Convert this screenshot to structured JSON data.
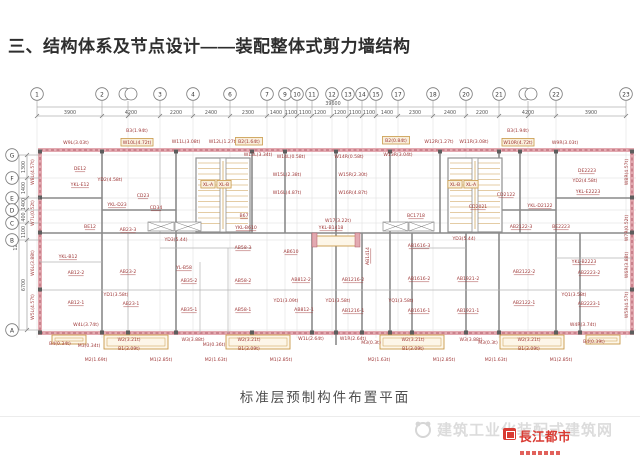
{
  "title": "三、结构体系及节点设计——装配整体式剪力墙结构",
  "caption": "标准层预制构件布置平面",
  "watermark": {
    "site_text": "建筑工业化装配式建筑网",
    "logo_text": "長江都市"
  },
  "colors": {
    "label_red": "#9e3636",
    "wall_pink": "#e3aab1",
    "wall_accent": "#b05866",
    "box_tan": "#c99a4a",
    "logo_red": "#d93a32",
    "dim_gray": "#555555"
  },
  "plan": {
    "grid_top": {
      "total": "39600",
      "bubbles": [
        {
          "n": "1",
          "x": 37
        },
        {
          "n": "2",
          "x": 102
        },
        {
          "n": "",
          "x": 128,
          "d": 1
        },
        {
          "n": "3",
          "x": 160
        },
        {
          "n": "4",
          "x": 193
        },
        {
          "n": "6",
          "x": 230
        },
        {
          "n": "7",
          "x": 267
        },
        {
          "n": "9",
          "x": 285
        },
        {
          "n": "10",
          "x": 297
        },
        {
          "n": "11",
          "x": 312
        },
        {
          "n": "12",
          "x": 332
        },
        {
          "n": "13",
          "x": 348
        },
        {
          "n": "14",
          "x": 362
        },
        {
          "n": "15",
          "x": 376
        },
        {
          "n": "17",
          "x": 398
        },
        {
          "n": "18",
          "x": 433
        },
        {
          "n": "20",
          "x": 466
        },
        {
          "n": "21",
          "x": 499
        },
        {
          "n": "",
          "x": 528,
          "d": 1
        },
        {
          "n": "22",
          "x": 556
        },
        {
          "n": "23",
          "x": 626
        }
      ],
      "dims": [
        {
          "v": "3900",
          "x": 70
        },
        {
          "v": "4200",
          "x": 131
        },
        {
          "v": "2200",
          "x": 176
        },
        {
          "v": "2400",
          "x": 211
        },
        {
          "v": "2300",
          "x": 248
        },
        {
          "v": "1400",
          "x": 276
        },
        {
          "v": "1100",
          "x": 291
        },
        {
          "v": "1100",
          "x": 305
        },
        {
          "v": "1200",
          "x": 320
        },
        {
          "v": "1200",
          "x": 340
        },
        {
          "v": "1100",
          "x": 355
        },
        {
          "v": "1100",
          "x": 369
        },
        {
          "v": "1400",
          "x": 387
        },
        {
          "v": "2300",
          "x": 415
        },
        {
          "v": "2400",
          "x": 450
        },
        {
          "v": "2200",
          "x": 482
        },
        {
          "v": "4200",
          "x": 528
        },
        {
          "v": "3900",
          "x": 591
        }
      ]
    },
    "grid_left": {
      "total": "12300",
      "bubbles": [
        {
          "n": "G",
          "y": 155
        },
        {
          "n": "F",
          "y": 178
        },
        {
          "n": "E",
          "y": 198
        },
        {
          "n": "D",
          "y": 210
        },
        {
          "n": "C",
          "y": 223
        },
        {
          "n": "B",
          "y": 240
        },
        {
          "n": "A",
          "y": 330
        }
      ],
      "dims": [
        {
          "v": "1300",
          "y": 167
        },
        {
          "v": "1400",
          "y": 188
        },
        {
          "v": "1400",
          "y": 204
        },
        {
          "v": "400",
          "y": 217
        },
        {
          "v": "1100",
          "y": 232
        },
        {
          "v": "6700",
          "y": 285
        }
      ]
    },
    "labels": [
      {
        "t": "W9L(3.03t)",
        "x": 76,
        "y": 144
      },
      {
        "t": "B3(1.94t)",
        "x": 137,
        "y": 132
      },
      {
        "t": "W10L(4.72t)",
        "x": 137,
        "y": 144,
        "b": 1
      },
      {
        "t": "W11L(3.08t)",
        "x": 186,
        "y": 143
      },
      {
        "t": "W12L(1.27t)",
        "x": 223,
        "y": 143
      },
      {
        "t": "B2(1.64t)",
        "x": 249,
        "y": 143,
        "b": 1
      },
      {
        "t": "W13L(3.34t)",
        "x": 258,
        "y": 156
      },
      {
        "t": "W14L(0.58t)",
        "x": 291,
        "y": 158
      },
      {
        "t": "W15L(2.38t)",
        "x": 287,
        "y": 176
      },
      {
        "t": "W16L(4.87t)",
        "x": 287,
        "y": 194
      },
      {
        "t": "W14R(0.58t)",
        "x": 349,
        "y": 158
      },
      {
        "t": "W15R(2.30t)",
        "x": 353,
        "y": 176
      },
      {
        "t": "W16R(4.87t)",
        "x": 353,
        "y": 194
      },
      {
        "t": "B2(0.84t)",
        "x": 396,
        "y": 142,
        "b": 1
      },
      {
        "t": "W13R(3.04t)",
        "x": 398,
        "y": 156
      },
      {
        "t": "W12R(1.27t)",
        "x": 439,
        "y": 143
      },
      {
        "t": "W11R(3.08t)",
        "x": 474,
        "y": 143
      },
      {
        "t": "B3(1.94t)",
        "x": 518,
        "y": 132
      },
      {
        "t": "W10R(4.72t)",
        "x": 518,
        "y": 144,
        "b": 1
      },
      {
        "t": "W9R(3.03t)",
        "x": 565,
        "y": 144
      },
      {
        "t": "DE12",
        "x": 80,
        "y": 170,
        "u": 1
      },
      {
        "t": "YD2(4.58t)",
        "x": 110,
        "y": 181
      },
      {
        "t": "YKL-E12",
        "x": 80,
        "y": 186,
        "u": 1
      },
      {
        "t": "CD23",
        "x": 143,
        "y": 197,
        "u": 1
      },
      {
        "t": "YKL-D23",
        "x": 117,
        "y": 206,
        "u": 1
      },
      {
        "t": "CD34",
        "x": 156,
        "y": 209,
        "u": 1
      },
      {
        "t": "XL-A",
        "x": 208,
        "y": 186,
        "b": 1
      },
      {
        "t": "XL-B",
        "x": 224,
        "y": 186,
        "b": 1
      },
      {
        "t": "XL-B",
        "x": 455,
        "y": 186,
        "b": 1
      },
      {
        "t": "XL-A",
        "x": 471,
        "y": 186,
        "b": 1
      },
      {
        "t": "CD2122",
        "x": 506,
        "y": 196,
        "u": 1
      },
      {
        "t": "CD2021",
        "x": 478,
        "y": 208,
        "u": 1
      },
      {
        "t": "YKL-D2122",
        "x": 540,
        "y": 207,
        "u": 1
      },
      {
        "t": "DE2223",
        "x": 587,
        "y": 172,
        "u": 1
      },
      {
        "t": "YD2(4.58t)",
        "x": 585,
        "y": 182
      },
      {
        "t": "YKL-E2223",
        "x": 588,
        "y": 193,
        "u": 1
      },
      {
        "t": "BE12",
        "x": 90,
        "y": 228,
        "u": 1
      },
      {
        "t": "AB23-3",
        "x": 128,
        "y": 231,
        "u": 1
      },
      {
        "t": "B67",
        "x": 244,
        "y": 217,
        "u": 1
      },
      {
        "t": "YD3(5.44)",
        "x": 176,
        "y": 241
      },
      {
        "t": "W17(3.22t)",
        "x": 338,
        "y": 222
      },
      {
        "t": "YKL-B610",
        "x": 246,
        "y": 229,
        "u": 1
      },
      {
        "t": "YKL-B1418",
        "x": 331,
        "y": 229,
        "u": 1
      },
      {
        "t": "BC1718",
        "x": 416,
        "y": 217,
        "u": 1
      },
      {
        "t": "AB2122-3",
        "x": 521,
        "y": 228,
        "u": 1
      },
      {
        "t": "BE2223",
        "x": 561,
        "y": 228,
        "u": 1
      },
      {
        "t": "YD3(5.44)",
        "x": 464,
        "y": 240
      },
      {
        "t": "AB1616-3",
        "x": 419,
        "y": 247,
        "u": 1
      },
      {
        "t": "AB58-3",
        "x": 243,
        "y": 249,
        "u": 1
      },
      {
        "t": "AB610",
        "x": 291,
        "y": 253,
        "u": 1
      },
      {
        "t": "AB1414",
        "x": 369,
        "y": 256,
        "r": -90,
        "u": 1
      },
      {
        "t": "YKL-B12",
        "x": 68,
        "y": 258,
        "u": 1
      },
      {
        "t": "AB12-2",
        "x": 76,
        "y": 274,
        "u": 1
      },
      {
        "t": "AB23-2",
        "x": 128,
        "y": 273,
        "u": 1
      },
      {
        "t": "YL-B58",
        "x": 184,
        "y": 269,
        "u": 1
      },
      {
        "t": "AB35-2",
        "x": 189,
        "y": 282,
        "u": 1
      },
      {
        "t": "AB58-2",
        "x": 243,
        "y": 282,
        "u": 1
      },
      {
        "t": "AB812-2",
        "x": 301,
        "y": 281,
        "u": 1
      },
      {
        "t": "AB1216-2",
        "x": 353,
        "y": 281,
        "u": 1
      },
      {
        "t": "AB1616-2",
        "x": 419,
        "y": 280,
        "u": 1
      },
      {
        "t": "AB1921-2",
        "x": 468,
        "y": 280,
        "u": 1
      },
      {
        "t": "AB2122-2",
        "x": 524,
        "y": 273,
        "u": 1
      },
      {
        "t": "YKL-B2223",
        "x": 584,
        "y": 263,
        "u": 1
      },
      {
        "t": "AB2223-2",
        "x": 589,
        "y": 274,
        "u": 1
      },
      {
        "t": "AB12-1",
        "x": 76,
        "y": 304,
        "u": 1
      },
      {
        "t": "YD1(3.58t)",
        "x": 116,
        "y": 296
      },
      {
        "t": "AB23-1",
        "x": 131,
        "y": 305,
        "u": 1
      },
      {
        "t": "AB35-1",
        "x": 189,
        "y": 311,
        "u": 1
      },
      {
        "t": "AB58-1",
        "x": 243,
        "y": 311,
        "u": 1
      },
      {
        "t": "YD1(3.09t)",
        "x": 286,
        "y": 302
      },
      {
        "t": "AB812-1",
        "x": 304,
        "y": 311,
        "u": 1
      },
      {
        "t": "YD1(3.58t)",
        "x": 338,
        "y": 302
      },
      {
        "t": "AB1216-1",
        "x": 353,
        "y": 312,
        "u": 1
      },
      {
        "t": "YQ1(3.58t)",
        "x": 401,
        "y": 302
      },
      {
        "t": "AB1616-1",
        "x": 419,
        "y": 312,
        "u": 1
      },
      {
        "t": "AB1921-1",
        "x": 468,
        "y": 312,
        "u": 1
      },
      {
        "t": "AB2122-1",
        "x": 524,
        "y": 304,
        "u": 1
      },
      {
        "t": "YQ1(3.58t)",
        "x": 574,
        "y": 296
      },
      {
        "t": "AB2223-1",
        "x": 589,
        "y": 305,
        "u": 1
      },
      {
        "t": "W4L(3.74t)",
        "x": 86,
        "y": 326
      },
      {
        "t": "B4(0.34t)",
        "x": 60,
        "y": 345
      },
      {
        "t": "M3(0.34t)",
        "x": 89,
        "y": 347
      },
      {
        "t": "W2(3.21t)",
        "x": 129,
        "y": 341
      },
      {
        "t": "B1(3.09t)",
        "x": 129,
        "y": 350
      },
      {
        "t": "M2(1.69t)",
        "x": 96,
        "y": 361
      },
      {
        "t": "M1(2.85t)",
        "x": 161,
        "y": 361
      },
      {
        "t": "W3(3.88t)",
        "x": 193,
        "y": 341
      },
      {
        "t": "M3(0.36t)",
        "x": 214,
        "y": 346
      },
      {
        "t": "W2(3.21t)",
        "x": 249,
        "y": 341
      },
      {
        "t": "B1(3.09t)",
        "x": 249,
        "y": 350
      },
      {
        "t": "M2(1.63t)",
        "x": 216,
        "y": 361
      },
      {
        "t": "M1(2.85t)",
        "x": 281,
        "y": 361
      },
      {
        "t": "W1L(2.64t)",
        "x": 311,
        "y": 340
      },
      {
        "t": "W1R(2.64t)",
        "x": 353,
        "y": 340
      },
      {
        "t": "M3(0.3t)",
        "x": 371,
        "y": 344
      },
      {
        "t": "W2(3.21t)",
        "x": 413,
        "y": 341
      },
      {
        "t": "B1(3.09t)",
        "x": 413,
        "y": 350
      },
      {
        "t": "M2(1.63t)",
        "x": 379,
        "y": 361
      },
      {
        "t": "M1(2.85t)",
        "x": 444,
        "y": 361
      },
      {
        "t": "W3(3.88t)",
        "x": 471,
        "y": 341
      },
      {
        "t": "M3(0.3t)",
        "x": 488,
        "y": 344
      },
      {
        "t": "W2(3.21t)",
        "x": 529,
        "y": 341
      },
      {
        "t": "B1(3.09t)",
        "x": 529,
        "y": 350
      },
      {
        "t": "M2(1.63t)",
        "x": 496,
        "y": 361
      },
      {
        "t": "M1(2.85t)",
        "x": 561,
        "y": 361
      },
      {
        "t": "W4R(3.74t)",
        "x": 583,
        "y": 326
      },
      {
        "t": "B4(0.39t)",
        "x": 594,
        "y": 343
      },
      {
        "t": "W8L(4.57t)",
        "x": 34,
        "y": 172,
        "r": -90
      },
      {
        "t": "W7L(0.52t)",
        "x": 34,
        "y": 213,
        "r": -90
      },
      {
        "t": "W6L(3.88t)",
        "x": 34,
        "y": 263,
        "r": -90
      },
      {
        "t": "W5L(4.57t)",
        "x": 34,
        "y": 307,
        "r": -90
      },
      {
        "t": "W8R(4.57t)",
        "x": 628,
        "y": 172,
        "r": -90
      },
      {
        "t": "W7R(0.52t)",
        "x": 628,
        "y": 228,
        "r": -90
      },
      {
        "t": "W6R(3.88t)",
        "x": 628,
        "y": 265,
        "r": -90
      },
      {
        "t": "W5R(4.57t)",
        "x": 628,
        "y": 305,
        "r": -90
      }
    ]
  }
}
